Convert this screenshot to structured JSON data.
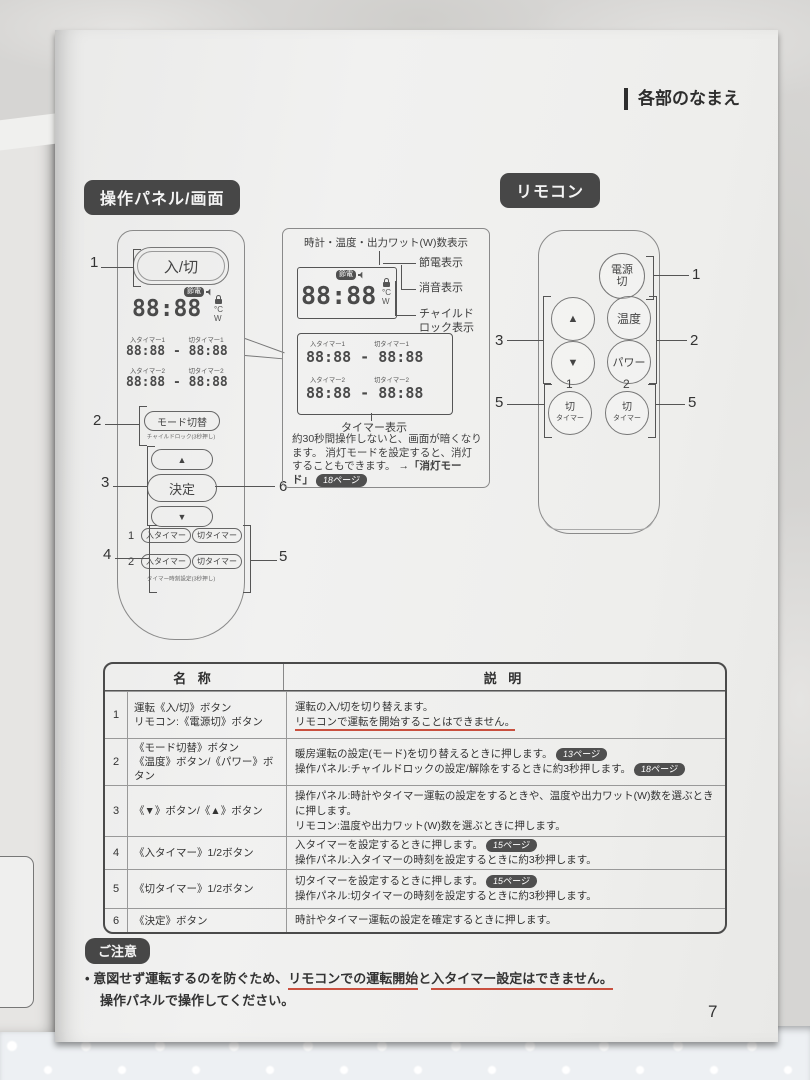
{
  "page_header": "各部のなまえ",
  "page_number": "7",
  "section_badges": {
    "panel": "操作パネル/画面",
    "remote": "リモコン"
  },
  "panel": {
    "power_button": "入/切",
    "display": {
      "main": "88:88",
      "eco_badge": "節電",
      "unit_c": "°C",
      "unit_w": "W",
      "timers": [
        {
          "on": "入タイマー1",
          "off": "切タイマー1",
          "value": "88:88 - 88:88"
        },
        {
          "on": "入タイマー2",
          "off": "切タイマー2",
          "value": "88:88 - 88:88"
        }
      ]
    },
    "mode_button": "モード切替",
    "mode_caption": "チャイルドロック(3秒押し)",
    "up_button": "▲",
    "enter_button": "決定",
    "down_button": "▼",
    "timer_rows": [
      {
        "num": "1",
        "on": "入タイマー",
        "off": "切タイマー"
      },
      {
        "num": "2",
        "on": "入タイマー",
        "off": "切タイマー"
      }
    ],
    "timer_caption": "タイマー時刻設定(3秒押し)",
    "callouts": {
      "c1": "1",
      "c2": "2",
      "c3": "3",
      "c4": "4",
      "c5": "5",
      "c6": "6"
    }
  },
  "display_callout": {
    "top_label": "時計・温度・出力ワット(W)数表示",
    "eco_label": "節電表示",
    "mute_label": "消音表示",
    "lock_label_1": "チャイルド",
    "lock_label_2": "ロック表示",
    "timer_caption": "タイマー表示",
    "note1": "約30秒間操作しないと、画面が暗くなります。",
    "note2": "消灯モードを設定すると、消灯することもできます。",
    "note2_link": "→「消灯モード」",
    "note2_badge": "18ページ"
  },
  "remote": {
    "power_line1": "電源",
    "power_line2": "切",
    "up": "▲",
    "down": "▼",
    "temp": "温度",
    "power": "パワー",
    "offtimer_line1": "切",
    "offtimer_line2": "タイマー",
    "num1": "1",
    "num2": "2",
    "callouts": {
      "power": "1",
      "right": "2",
      "left": "3",
      "off_left": "5",
      "off_right": "5"
    }
  },
  "table": {
    "header_name": "名 称",
    "header_desc": "説 明",
    "rows": [
      {
        "num": "1",
        "name1": "運転《入/切》ボタン",
        "name2": "リモコン:《電源切》ボタン",
        "desc1": "運転の入/切を切り替えます。",
        "desc2": "リモコンで運転を開始することはできません。"
      },
      {
        "num": "2",
        "name1": "《モード切替》ボタン",
        "name2": "《温度》ボタン/《パワー》ボタン",
        "desc1": "暖房運転の設定(モード)を切り替えるときに押します。",
        "badge1": "13ページ",
        "desc2": "操作パネル:チャイルドロックの設定/解除をするときに約3秒押します。",
        "badge2": "18ページ"
      },
      {
        "num": "3",
        "name1": "《▼》ボタン/《▲》ボタン",
        "desc1": "操作パネル:時計やタイマー運転の設定をするときや、温度や出力ワット(W)数を選ぶときに押します。",
        "desc2": "リモコン:温度や出力ワット(W)数を選ぶときに押します。"
      },
      {
        "num": "4",
        "name1": "《入タイマー》1/2ボタン",
        "desc1": "入タイマーを設定するときに押します。",
        "badge1": "15ページ",
        "desc2": "操作パネル:入タイマーの時刻を設定するときに約3秒押します。"
      },
      {
        "num": "5",
        "name1": "《切タイマー》1/2ボタン",
        "desc1": "切タイマーを設定するときに押します。",
        "badge1": "15ページ",
        "desc2": "操作パネル:切タイマーの時刻を設定するときに約3秒押します。"
      },
      {
        "num": "6",
        "name1": "《決定》ボタン",
        "desc1": "時計やタイマー運転の設定を確定するときに押します。"
      }
    ]
  },
  "notice": {
    "badge": "ご注意",
    "bullet": "•",
    "pre": "意図せず運転するのを防ぐため、",
    "underline1": "リモコンでの運転開始",
    "mid": "と",
    "underline2": "入タイマー設定はできません。",
    "line2": "操作パネルで操作してください。"
  }
}
